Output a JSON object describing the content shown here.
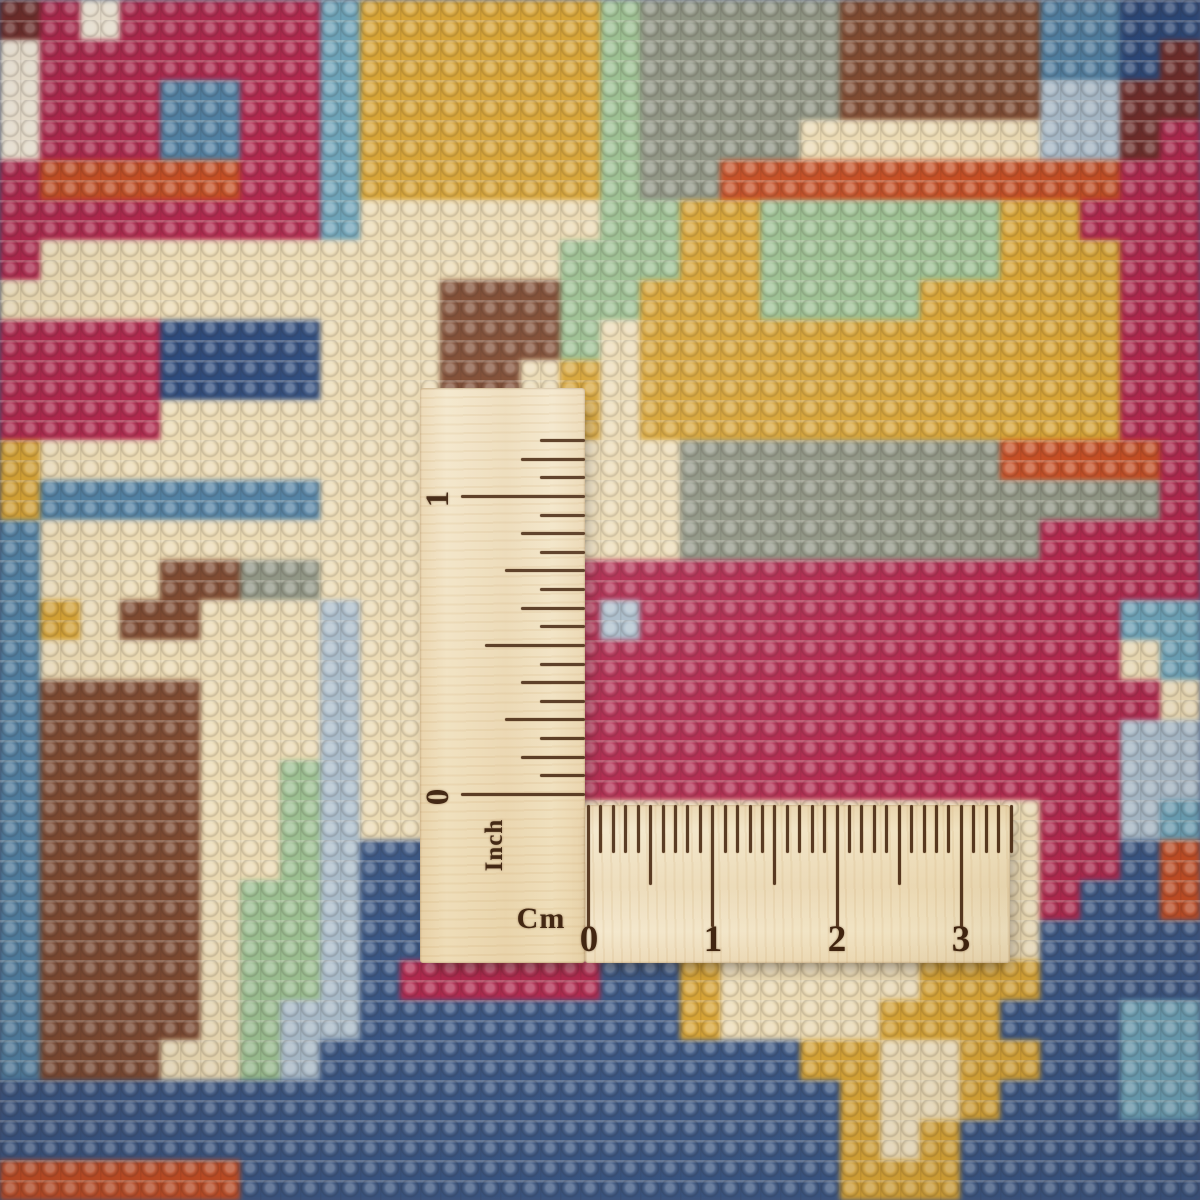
{
  "scene": {
    "type": "photograph",
    "subject": "Close-up of the knotted back of a multicolored oriental wool rug with an L-shaped wooden measuring ruler laid on top",
    "carpet_texture": "rows of wool knots with pale weft lines"
  },
  "ruler": {
    "wood_color": "#f1e4c6",
    "burn_color": "#40240f",
    "inch": {
      "unit_label": "Inch",
      "numerals": [
        "1",
        "0"
      ],
      "tick_count": 20,
      "tick_spacing_px": 18.63,
      "origin_top_px": 405
    },
    "cm": {
      "unit_label": "Cm",
      "numerals": [
        "0",
        "1",
        "2",
        "3"
      ],
      "tick_count": 35,
      "tick_spacing_px": 12.43,
      "origin_left_px": 2
    }
  },
  "carpet": {
    "cell_size_px": 40,
    "columns": 30,
    "palette": {
      "m": "#a92a4e",
      "r": "#bf4f28",
      "b": "#54809f",
      "t": "#6fa0b4",
      "n": "#2f4a78",
      "d": "#3c5680",
      "y": "#d3a33c",
      "e": "#e9d9b5",
      "g": "#9dbd92",
      "s": "#8e9383",
      "w": "#7b4b33",
      "c": "#efe6d4",
      "p": "#a9bac7",
      "k": "#6e2f2c"
    },
    "rows": [
      "kmcmmmmmtyyyyyygssssswwwwwbbnn",
      "cmmmmmmmtyyyyyygssssswwwwwbbnk",
      "cmmmbbmmtyyyyyygssssswwwwwppkk",
      "cmmmbbmmtyyyyyygsssseeeeeeppkm",
      "mrrrrrmmtyyyyyygssrrrrrrrrrrmm",
      "mmmmmmmmteeeeeeggyyggggggyymmm",
      "meeeeeeeeeeeeegggyyggggggyyymm",
      "eeeeeeeeeeewwwggyyyggggyyyyymm",
      "mmmmnnnneeewwwgeyyyyyyyyyyyymm",
      "mmmmnnnneeewweyeyyyyyyyyyyyymm",
      "mmmmeeeeeeeeeeyeyyyyyyyyyyyymm",
      "yeeeeeeeeeeeeeeeessssssssrrrrm",
      "ybbbbbbbeeeeeeeeessssssssssssm",
      "beeeeeeeeeeeeeeeesssssssssmmmm",
      "beeewwsseeeeeemmmmmmmmmmmmmmmm",
      "byewweeepeeeeempmmmmmmmmmmmmtt",
      "beeeeeeepeeeeemmmmmmmmmmmmmmet",
      "bwwwweeepeeeeemmmmmmmmmmmmmmme",
      "bwwwweeepeeeeemmmmmmmmmmmmmmpp",
      "bwwwweegpeeeeemmmmmmmmmmmmmmpp",
      "bwwwweegpeeeeeeeeeeeeeeeeemmpt",
      "bwwwweegpddeeeeeeeeeeeeeeemmdr",
      "bwwwweggpddeeeeeeeeeeeeeeemddr",
      "bwwwweggpddeeeeeeeeeeeeeeedddd",
      "bwwwweggpdmmmmmddyeeeeeyyydddd",
      "bwwwwegppddddddddyeeeeyyydddtt",
      "bwwweegpddddddddddddyyeeyyddtt",
      "dddddddddddddddddddddyeeydddtt",
      "dddddddddddddddddddddyeydddddd",
      "rrrrrrdddddddddddddddyyydddddd"
    ]
  }
}
